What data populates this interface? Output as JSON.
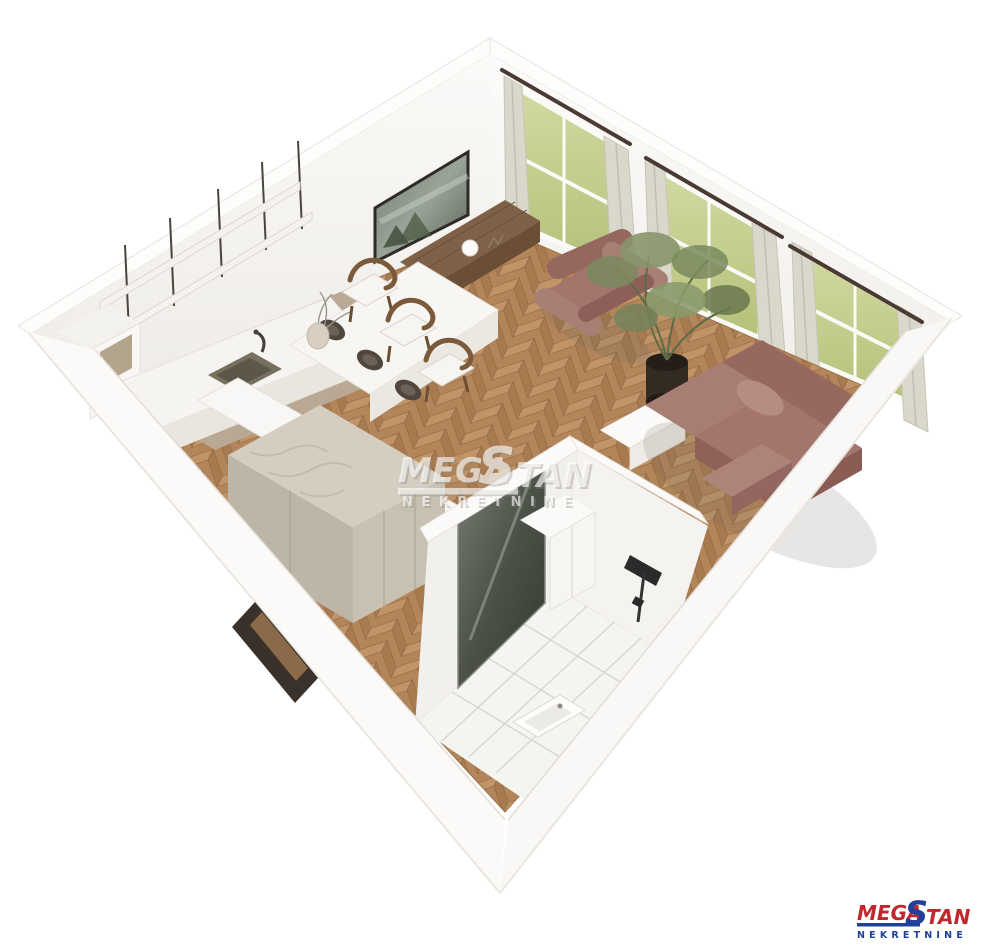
{
  "watermark": {
    "mega": "MEGA",
    "s": "S",
    "tan": "TAN",
    "subtitle": "NEKRETNINE"
  },
  "logo": {
    "mega": "MEGA",
    "s": "S",
    "tan": "TAN",
    "subtitle": "NEKRETNINE",
    "red": "#c1272d",
    "blue": "#21409a"
  },
  "palette": {
    "background": "#ffffff",
    "wall_white": "#f6f4f1",
    "parquet_brown": "#b3835a",
    "kitchen_floor_greige": "#b9a994",
    "sofa_mauve": "#a3756c",
    "armchair_mauve": "#a3756c",
    "plant_green": "#7a8a5e",
    "plant_pot_dark": "#2f2721",
    "curtain_beige": "#d8d7ca",
    "window_view_green": "#c3cc86",
    "bathroom_tile_white": "#f4f4f1",
    "console_wood": "#7f6148",
    "glass_door_grey": "#5d615a",
    "wardrobe_beige": "#d5cec0",
    "watermark_white": "#ffffff"
  }
}
